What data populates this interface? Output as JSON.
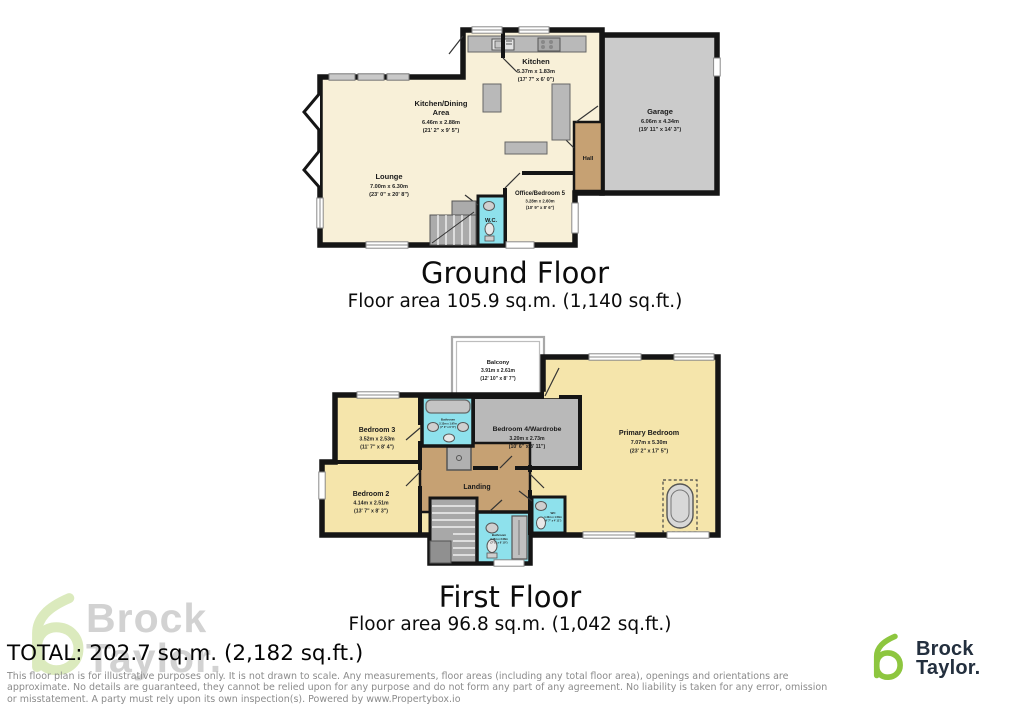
{
  "ground_floor": {
    "title": "Ground Floor",
    "area": "Floor area 105.9 sq.m. (1,140 sq.ft.)",
    "rooms": {
      "kitchen": {
        "name": "Kitchen",
        "metric": "5.37m x 1.83m",
        "imperial": "(17' 7\" x 6' 0\")"
      },
      "kitchen_dining": {
        "name1": "Kitchen/Dining",
        "name2": "Area",
        "metric": "6.46m x 2.88m",
        "imperial": "(21' 2\" x 9' 5\")"
      },
      "lounge": {
        "name": "Lounge",
        "metric": "7.00m x 6.30m",
        "imperial": "(23' 0\" x 20' 8\")"
      },
      "garage": {
        "name": "Garage",
        "metric": "6.06m x 4.34m",
        "imperial": "(19' 11\" x 14' 3\")"
      },
      "hall": {
        "name": "Hall"
      },
      "office": {
        "name": "Office/Bedroom 5",
        "metric": "3.28m x 2.60m",
        "imperial": "(10' 9\" x 8' 6\")"
      },
      "wc": {
        "name": "W.C."
      }
    }
  },
  "first_floor": {
    "title": "First Floor",
    "area": "Floor area 96.8 sq.m. (1,042 sq.ft.)",
    "rooms": {
      "balcony": {
        "name": "Balcony",
        "metric": "3.91m x 2.61m",
        "imperial": "(12' 10\" x 8' 7\")"
      },
      "bedroom3": {
        "name": "Bedroom 3",
        "metric": "3.52m x 2.53m",
        "imperial": "(11' 7\" x 8' 4\")"
      },
      "bedroom4": {
        "name": "Bedroom 4/Wardrobe",
        "metric": "3.20m x 2.73m",
        "imperial": "(10' 6\" x 8' 11\")"
      },
      "primary": {
        "name": "Primary Bedroom",
        "metric": "7.07m x 5.30m",
        "imperial": "(23' 2\" x 17' 5\")"
      },
      "bedroom2": {
        "name": "Bedroom 2",
        "metric": "4.14m x 2.51m",
        "imperial": "(13' 7\" x 8' 3\")"
      },
      "landing": {
        "name": "Landing"
      },
      "bathroom_top": {
        "name": "Bathroom",
        "metric": "2.13m x 1.97m",
        "imperial": "(7' 0\" x 6' 6\")"
      },
      "bathroom_bottom": {
        "name": "Bathroom",
        "metric": "2.16m x 2.08m",
        "imperial": "(7' 1\" x 6' 10\")"
      },
      "wc": {
        "name": "WC",
        "metric": "1.40m x 1.50m",
        "imperial": "(4' 7\" x 4' 11\")"
      }
    }
  },
  "footer": {
    "total": "TOTAL: 202.7 sq.m. (2,182 sq.ft.)",
    "disclaimer": "This floor plan is for illustrative purposes only. It is not drawn to scale. Any measurements, floor areas (including any total floor area), openings and orientations are approximate. No details are guaranteed, they cannot be relied upon for any purpose and do not form any part of any agreement. No liability is taken for any error, omission or misstatement. A party must rely upon its own inspection(s). Powered by www.Propertybox.io"
  },
  "branding": {
    "line1": "Brock",
    "line2": "Taylor.",
    "accent_green": "#8dc63f",
    "navy": "#232f3e",
    "watermark_gray": "#c7c7c7"
  },
  "colors": {
    "wall": "#151515",
    "room_cream_ground": "#f8f0d8",
    "room_cream_first": "#f5e5ab",
    "garage_gray": "#cbcbcb",
    "hall_tan": "#c6a173",
    "bathroom_cyan": "#8ee1ec",
    "furniture_gray": "#b9b9b9"
  }
}
